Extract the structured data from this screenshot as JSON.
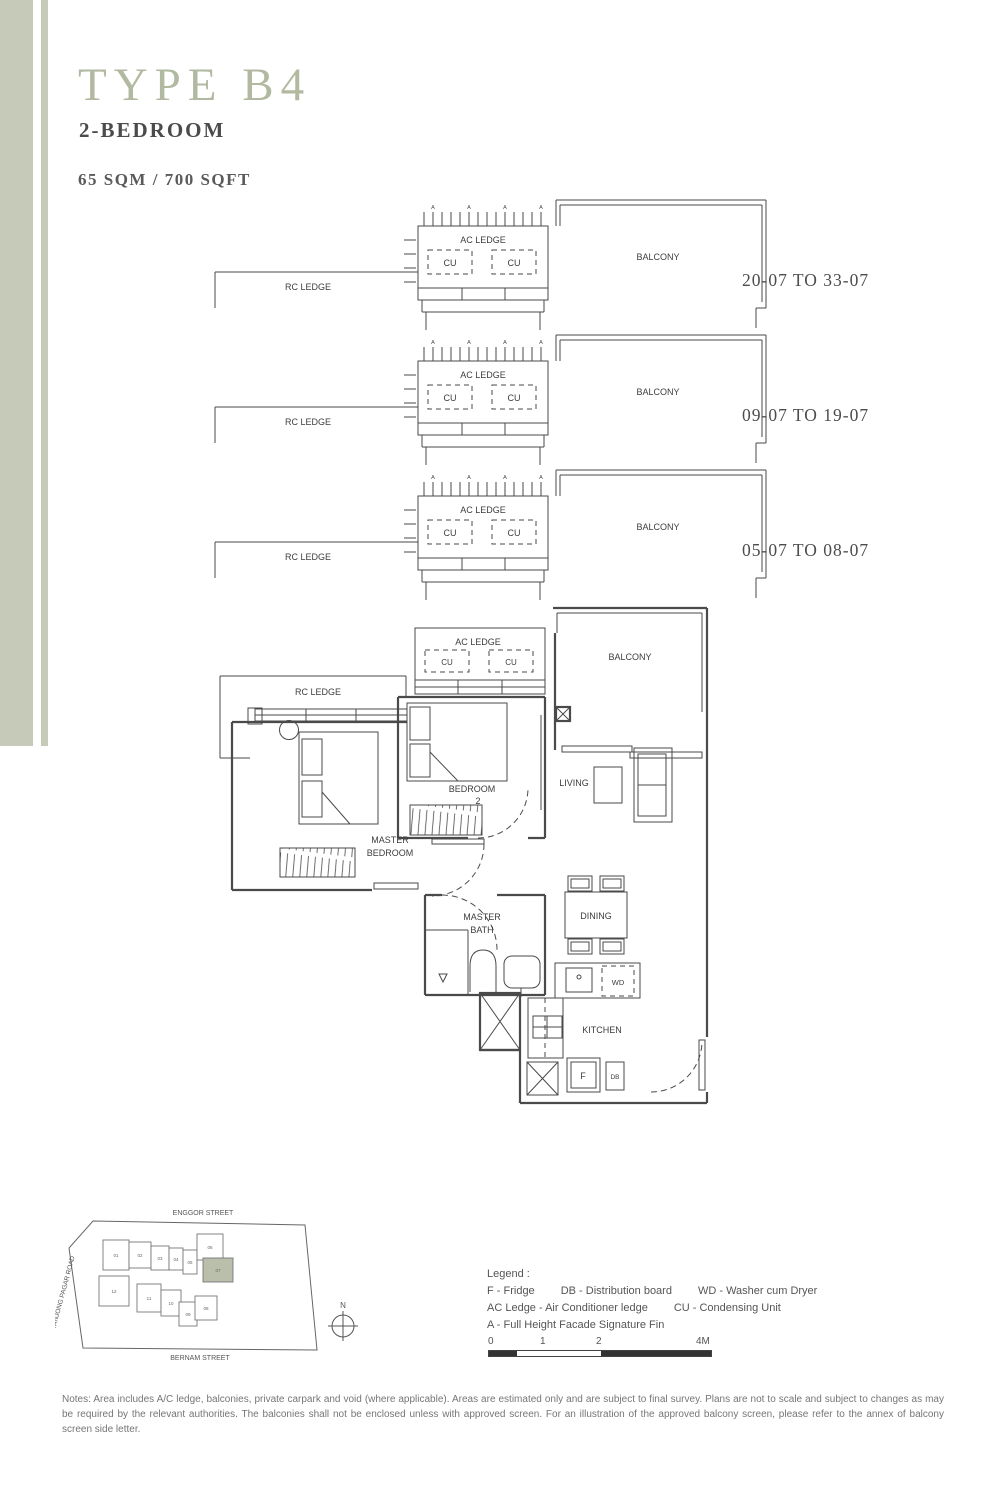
{
  "header": {
    "title": "TYPE B4",
    "subtitle": "2-BEDROOM",
    "area": "65 SQM / 700 SQFT"
  },
  "colors": {
    "accent": "#c6cbb9",
    "title_green": "#b2b9a1",
    "line": "#4a4a4a",
    "highlight": "#b9bfab"
  },
  "diagram_labels": {
    "ac_ledge": "AC LEDGE",
    "cu": "CU",
    "rc_ledge": "RC LEDGE",
    "balcony": "BALCONY",
    "fin": "A"
  },
  "stacks": [
    {
      "range": "20-07 TO 33-07"
    },
    {
      "range": "09-07 TO 19-07"
    },
    {
      "range": "05-07 TO 08-07"
    }
  ],
  "floor_plan": {
    "labels": {
      "ac_ledge": "AC LEDGE",
      "cu": "CU",
      "rc_ledge": "RC LEDGE",
      "balcony": "BALCONY",
      "master_line1": "MASTER",
      "master_line2": "BEDROOM",
      "bedroom2_line1": "BEDROOM",
      "bedroom2_line2": "2",
      "living": "LIVING",
      "dining": "DINING",
      "bath_line1": "MASTER",
      "bath_line2": "BATH",
      "kitchen": "KITCHEN",
      "wd": "WD",
      "fridge": "F",
      "db": "DB"
    }
  },
  "site_plan": {
    "streets": {
      "top": "ENGGOR STREET",
      "left": "TANJONG PAGAR ROAD",
      "bottom": "BERNAM STREET"
    },
    "north": "N",
    "units": [
      "01",
      "02",
      "03",
      "04",
      "05",
      "06",
      "07",
      "08",
      "09",
      "10",
      "11",
      "12"
    ],
    "highlighted_unit": "07"
  },
  "legend": {
    "title": "Legend :",
    "lines": [
      [
        "F - Fridge",
        "DB - Distribution board",
        "WD - Washer cum Dryer"
      ],
      [
        "AC Ledge - Air Conditioner ledge",
        "CU - Condensing Unit"
      ],
      [
        "A - Full Height Facade Signature Fin"
      ]
    ]
  },
  "scale_bar": {
    "labels": [
      "0",
      "1",
      "2",
      "4M"
    ]
  },
  "notes": {
    "text": "Notes: Area includes A/C ledge, balconies, private carpark and void (where applicable). Areas are estimated only and are subject to final survey. Plans are not to scale and subject to changes as may be required by the relevant authorities. The balconies shall not be enclosed unless with approved screen. For an illustration of the approved balcony screen, please refer to the annex of balcony screen side letter."
  }
}
